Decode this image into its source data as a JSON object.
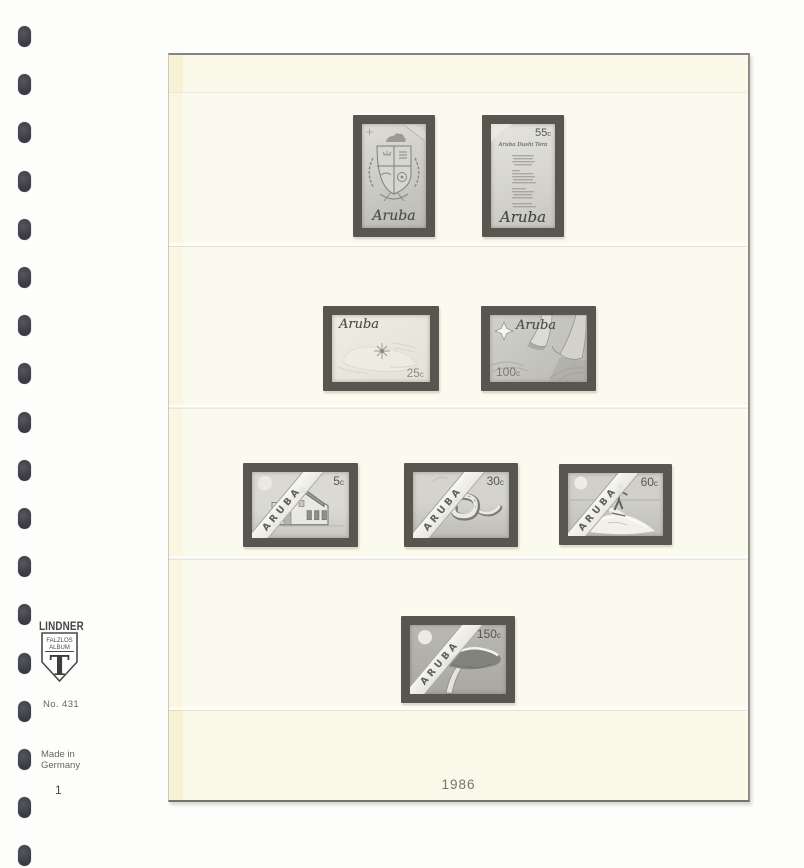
{
  "binder": {
    "hole_count": 18
  },
  "left_margin": {
    "brand": "LINDNER",
    "shield_top_line": "FALZLOS",
    "shield_bottom_line": "ALBUM",
    "shield_letter": "T",
    "model_number": "No. 431",
    "origin_line1": "Made in",
    "origin_line2": "Germany",
    "page_number": "1"
  },
  "album_page": {
    "year_caption": "1986",
    "row_count": 4,
    "stamp_count": 8
  },
  "stamps": [
    {
      "slot": "row-1-left",
      "design": "aruba-coat-of-arms",
      "country_script": "Aruba"
    },
    {
      "slot": "row-1-right",
      "design": "national-anthem-text",
      "country_script": "Aruba",
      "title_script": "Aruba Dushi Tera",
      "value_amount": "55",
      "value_unit": "c"
    },
    {
      "slot": "row-2-left",
      "design": "map-of-aruba",
      "country_script": "Aruba",
      "value_amount": "25",
      "value_unit": "c"
    },
    {
      "slot": "row-2-right",
      "design": "star-and-flag-ribbons",
      "country_script": "Aruba",
      "value_amount": "100",
      "value_unit": "c"
    },
    {
      "slot": "row-3-left",
      "design": "cunucu-house",
      "diagonal_text": "ARUBA",
      "value_amount": "5",
      "value_unit": "c"
    },
    {
      "slot": "row-3-middle",
      "design": "snake",
      "diagonal_text": "ARUBA",
      "value_amount": "30",
      "value_unit": "c"
    },
    {
      "slot": "row-3-right",
      "design": "water-skier",
      "diagonal_text": "ARUBA",
      "value_amount": "60",
      "value_unit": "c"
    },
    {
      "slot": "row-4-center",
      "design": "divi-divi-tree",
      "diagonal_text": "ARUBA",
      "value_amount": "150",
      "value_unit": "c"
    }
  ],
  "colors": {
    "page_background": "#faf8e8",
    "page_border": "#85857e",
    "mount_frame": "#59564f",
    "stamp_paper_light": "#dddcd6",
    "stamp_paper_dark": "#b0afaa",
    "binder_hole": "#3d3e45",
    "caption_text": "#75756e",
    "margin_text": "#4a4a48"
  }
}
